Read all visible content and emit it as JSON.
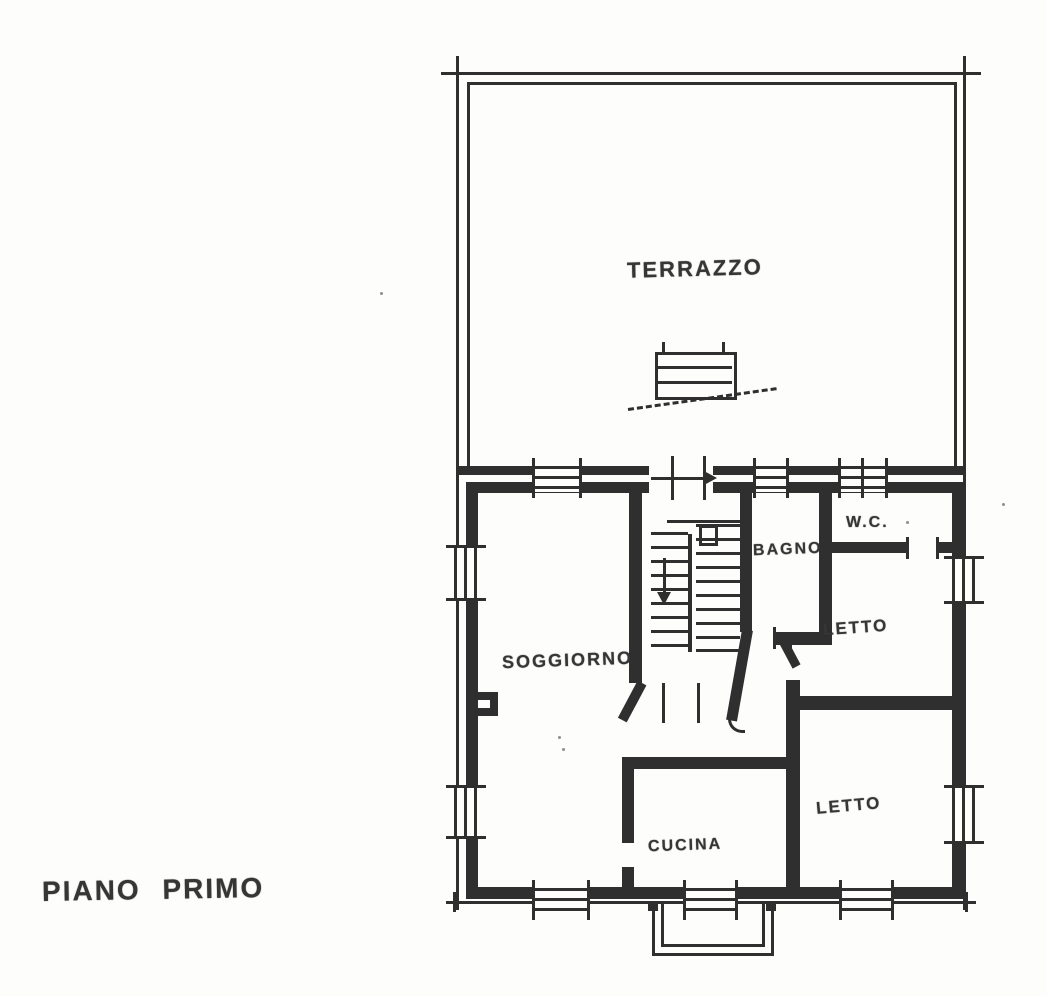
{
  "floor_plan": {
    "title": "PIANO PRIMO",
    "rooms": {
      "terrazzo": "TERRAZZO",
      "soggiorno": "SOGGIORNO",
      "bagno": "BAGNO",
      "wc": "W.C.",
      "letto_upper": "LETTO",
      "letto_lower": "LETTO",
      "cucina": "CUCINA"
    },
    "colors": {
      "ink": "#2f2f2f",
      "paper": "#fdfdfb"
    }
  }
}
